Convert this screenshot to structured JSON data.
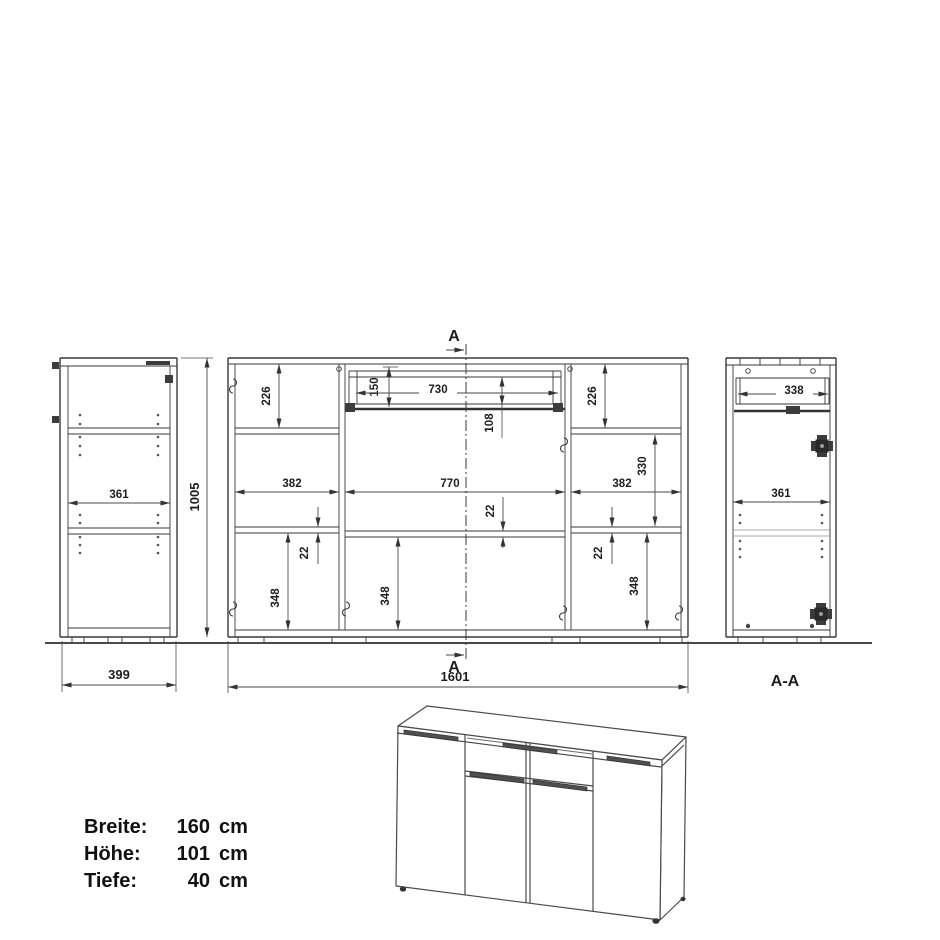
{
  "drawing": {
    "section_marker_top": "A",
    "section_marker_bottom": "A",
    "section_title": "A-A",
    "side": {
      "w361": "361",
      "w399": "399",
      "h1005": "1005"
    },
    "front": {
      "h226l": "226",
      "h150": "150",
      "w730": "730",
      "h108": "108",
      "h226r": "226",
      "h330": "330",
      "w382l": "382",
      "w770": "770",
      "w382r": "382",
      "t22l": "22",
      "t22m": "22",
      "t22r": "22",
      "h348l": "348",
      "h348m": "348",
      "h348r": "348",
      "w1601": "1601"
    },
    "section": {
      "w338": "338",
      "w361": "361"
    }
  },
  "specs": {
    "rows": [
      {
        "label": "Breite:",
        "value": "160",
        "unit": "cm"
      },
      {
        "label": "Höhe:",
        "value": "101",
        "unit": "cm"
      },
      {
        "label": "Tiefe:",
        "value": "40",
        "unit": "cm"
      }
    ]
  }
}
